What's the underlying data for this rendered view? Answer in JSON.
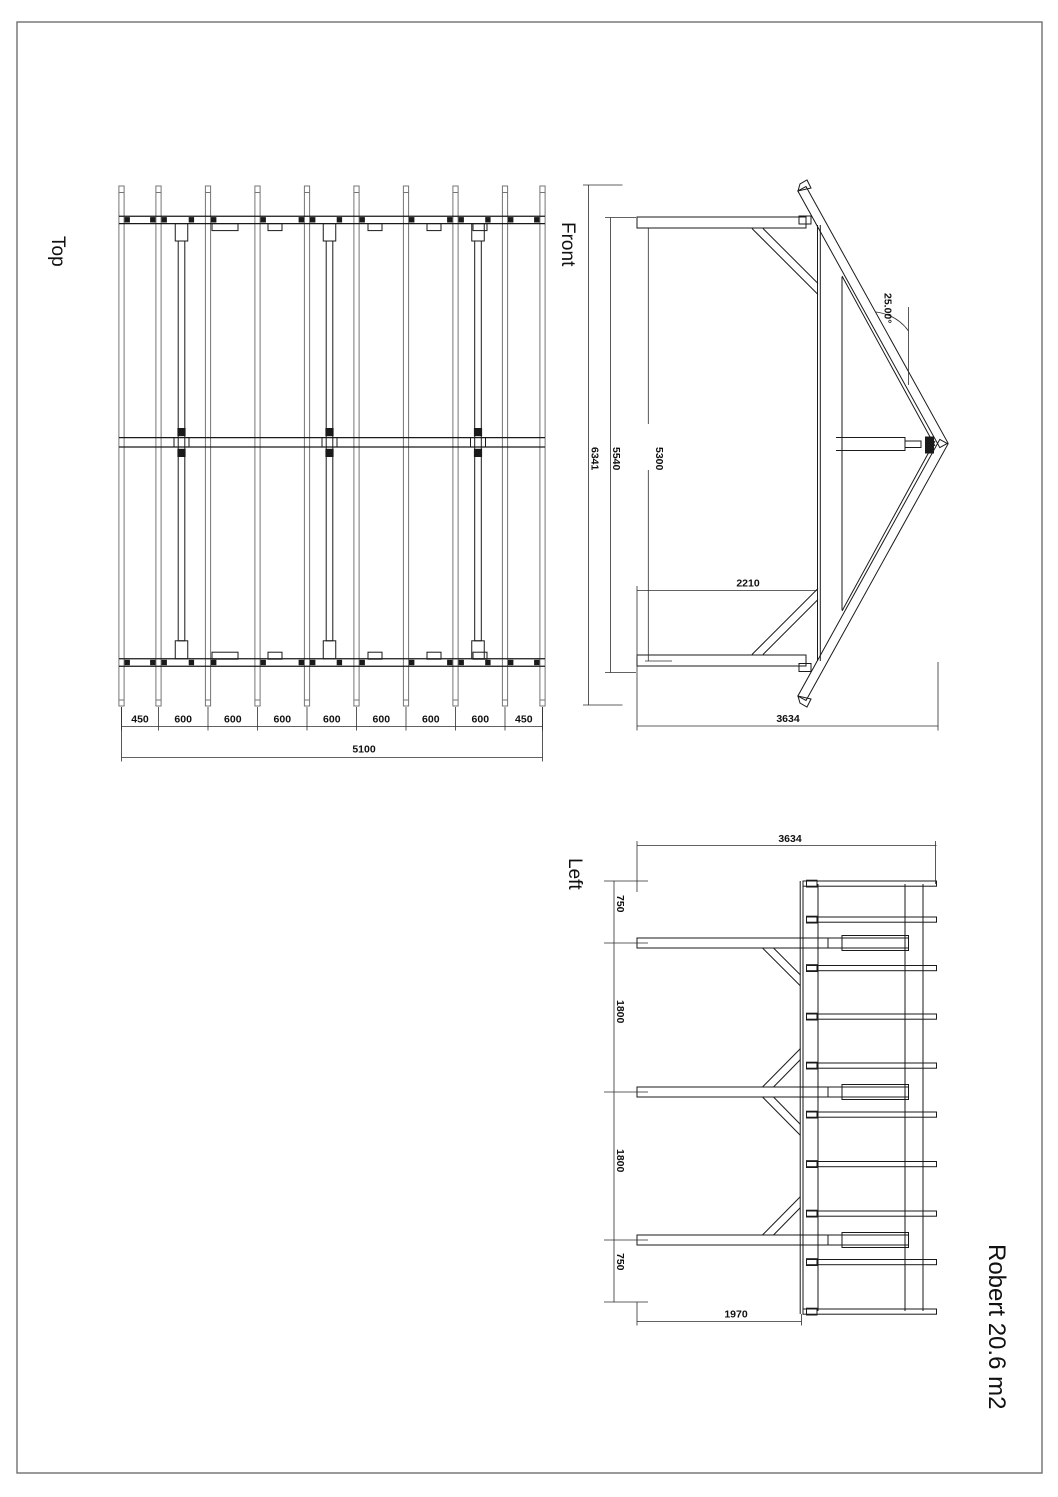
{
  "title": {
    "text": "Robert 20.6 m2"
  },
  "views": {
    "top": {
      "label": "Top",
      "segment_labels": [
        "450",
        "600",
        "600",
        "600",
        "600",
        "600",
        "600",
        "600",
        "450"
      ],
      "total": "5100"
    },
    "front": {
      "label": "Front",
      "dims": {
        "overall_width": "6341",
        "roof_width": "5540",
        "wall_width": "5300",
        "eave_height": "2210",
        "total_height": "3634",
        "angle": "25.00°"
      }
    },
    "left": {
      "label": "Left",
      "dims": {
        "width": "3634",
        "chain": [
          "750",
          "1800",
          "1800",
          "750"
        ],
        "base": "1970"
      }
    }
  }
}
